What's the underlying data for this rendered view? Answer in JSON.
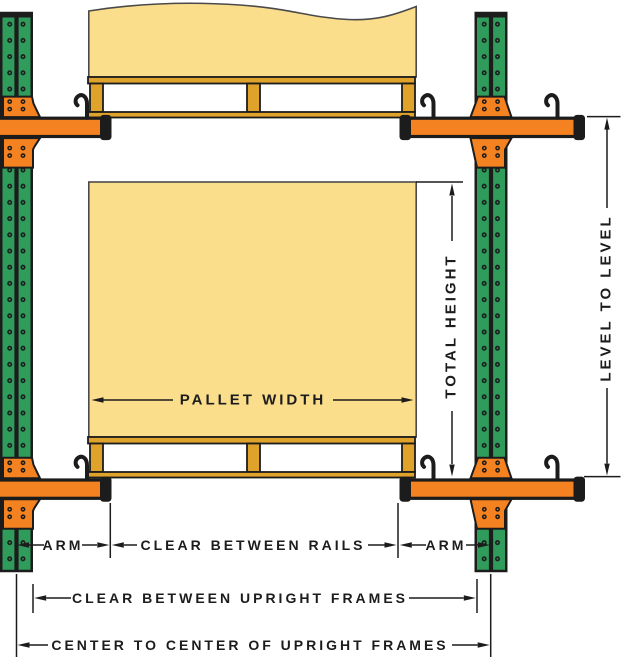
{
  "labels": {
    "pallet_width": "PALLET WIDTH",
    "total_height": "TOTAL HEIGHT",
    "level_to_level": "LEVEL TO LEVEL",
    "arm_left": "ARM",
    "arm_right": "ARM",
    "clear_between_rails": "CLEAR BETWEEN RAILS",
    "clear_between_upright_frames": "CLEAR BETWEEN UPRIGHT FRAMES",
    "center_to_center_of_upright_frames": "CENTER TO CENTER OF UPRIGHT FRAMES"
  },
  "colors": {
    "upright_green": "#2F9C5C",
    "arm_orange": "#F58220",
    "load_yellow": "#FADE8C",
    "pallet_wood": "#DFA32B",
    "outline_black": "#1C1C1C"
  }
}
